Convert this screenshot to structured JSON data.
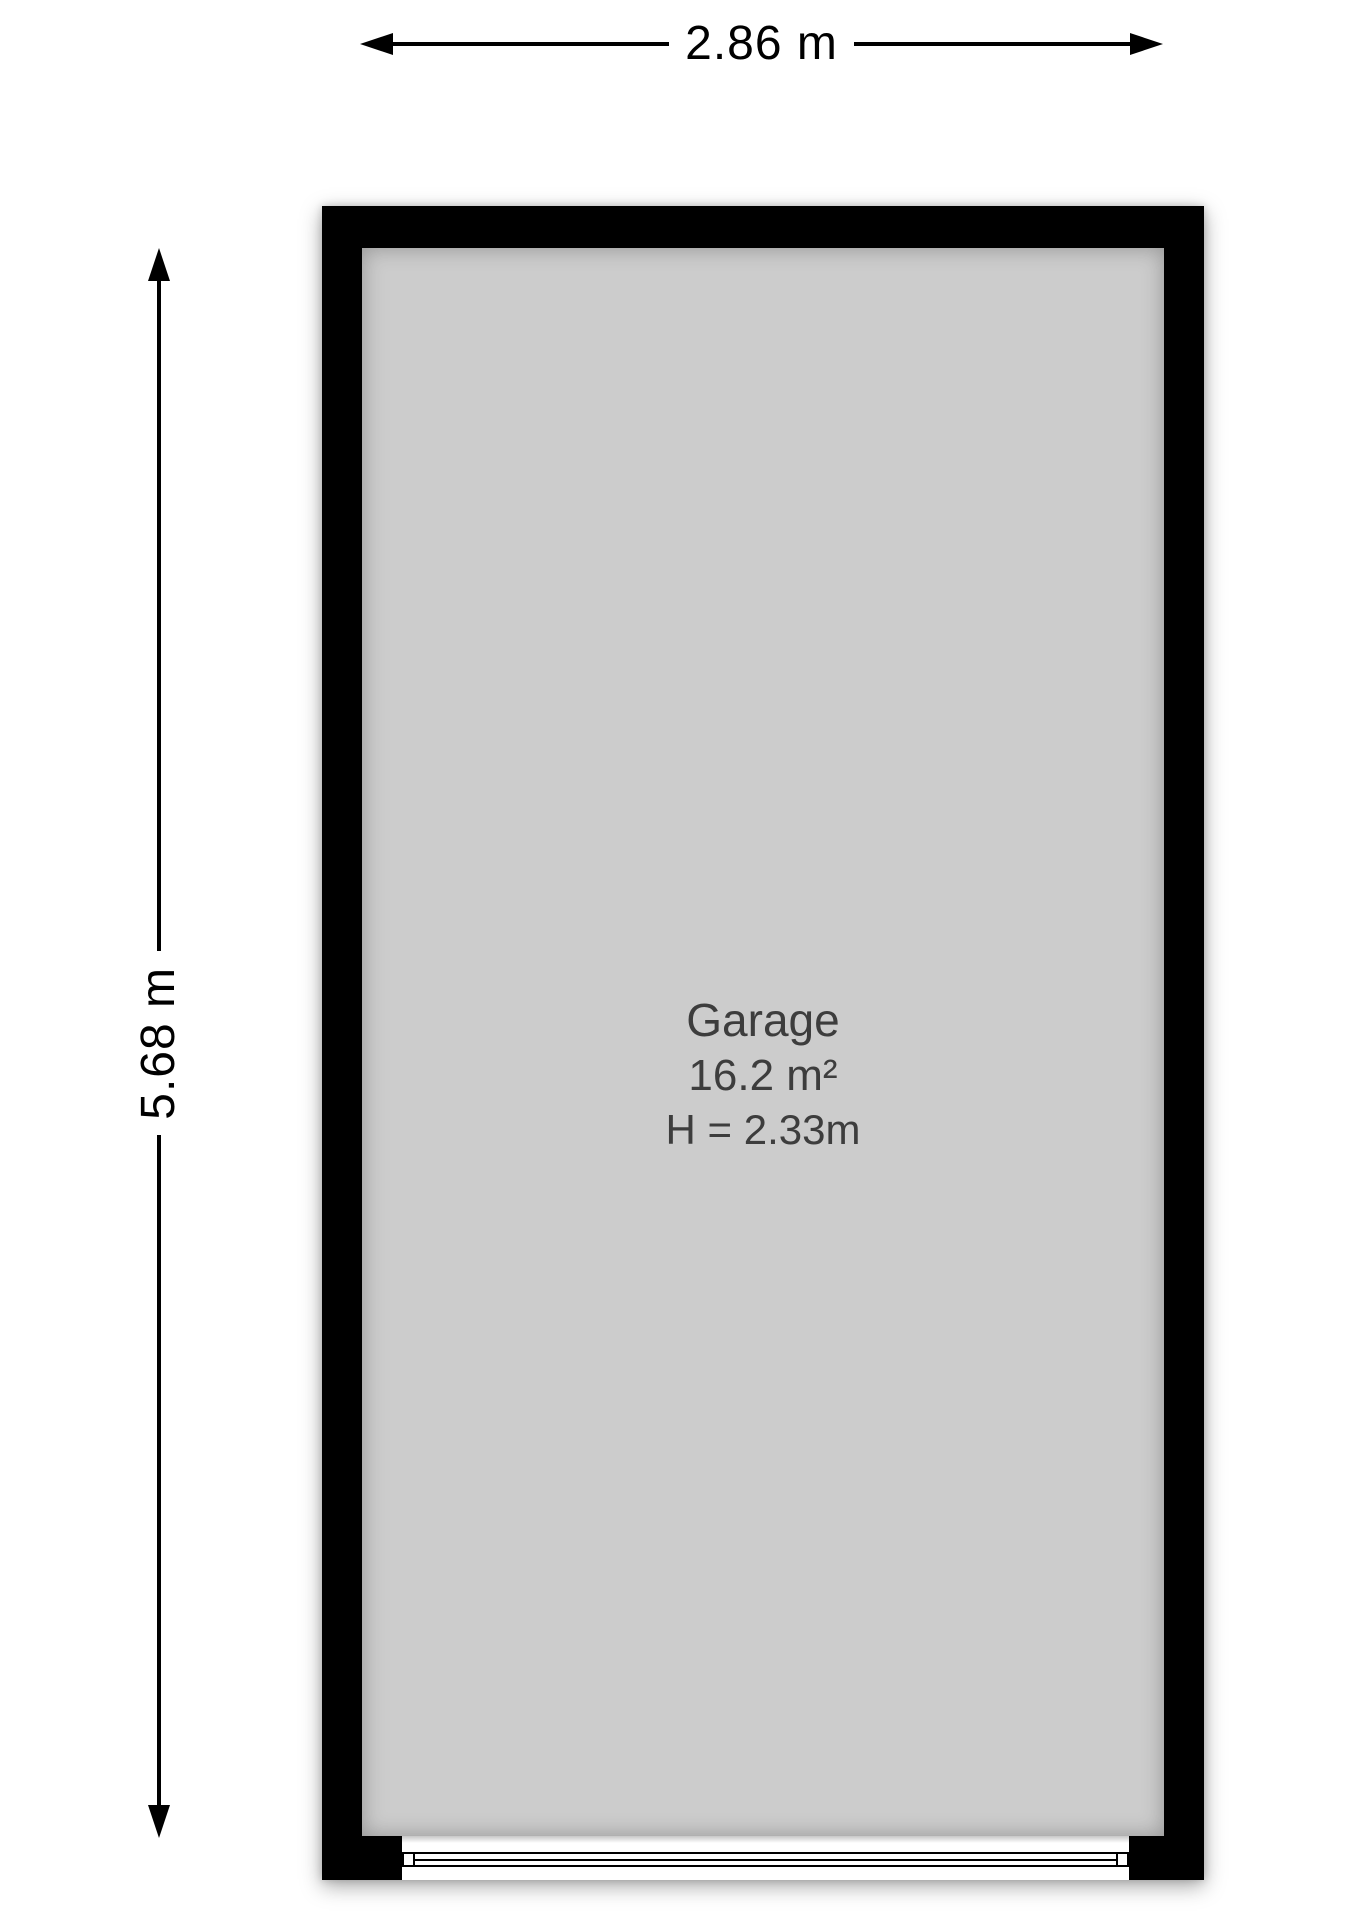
{
  "diagram": {
    "type": "floor-plan",
    "room": {
      "name": "Garage",
      "area": "16.2 m²",
      "ceiling_height": "H = 2.33m"
    },
    "dimensions": {
      "width": "2.86 m",
      "height": "5.68 m"
    },
    "icons": {
      "width_arrows": [
        "arrow-left-icon",
        "arrow-right-icon"
      ],
      "height_arrows": [
        "arrow-up-icon",
        "arrow-down-icon"
      ]
    },
    "colors": {
      "wall": "#000000",
      "floor": "#cccccc",
      "background": "#ffffff",
      "dimensionText": "#000000",
      "roomText": "#3d3d3d",
      "door": "#ffffff"
    }
  }
}
